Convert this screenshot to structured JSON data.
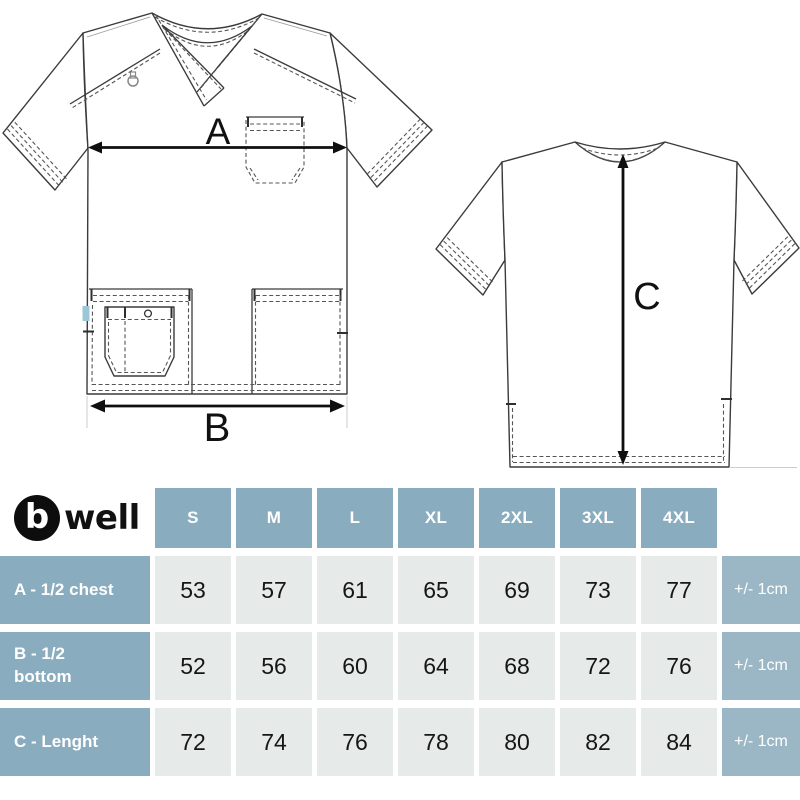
{
  "brand": {
    "mark_letter": "b",
    "name_rest": "well"
  },
  "diagram": {
    "labels": {
      "chest_width": "A",
      "bottom_width": "B",
      "length": "C"
    }
  },
  "size_table": {
    "sizes": [
      "S",
      "M",
      "L",
      "XL",
      "2XL",
      "3XL",
      "4XL"
    ],
    "rows": [
      {
        "label": "A - 1/2 chest",
        "values": [
          "53",
          "57",
          "61",
          "65",
          "69",
          "73",
          "77"
        ],
        "tolerance": "+/- 1cm"
      },
      {
        "label": "B - 1/2 bottom",
        "values": [
          "52",
          "56",
          "60",
          "64",
          "68",
          "72",
          "76"
        ],
        "tolerance": "+/- 1cm"
      },
      {
        "label": "C - Lenght",
        "values": [
          "72",
          "74",
          "76",
          "78",
          "80",
          "82",
          "84"
        ],
        "tolerance": "+/- 1cm"
      }
    ]
  },
  "colors": {
    "header_bg": "#8aacbf",
    "tolerance_bg": "#9bb7c5",
    "value_bg": "#e6ebea",
    "header_text": "#ffffff",
    "value_text": "#161616",
    "logo_black": "#0d0d0d",
    "garment_line": "#3b3b3b",
    "side_tag_blue": "#9cc7d8"
  }
}
